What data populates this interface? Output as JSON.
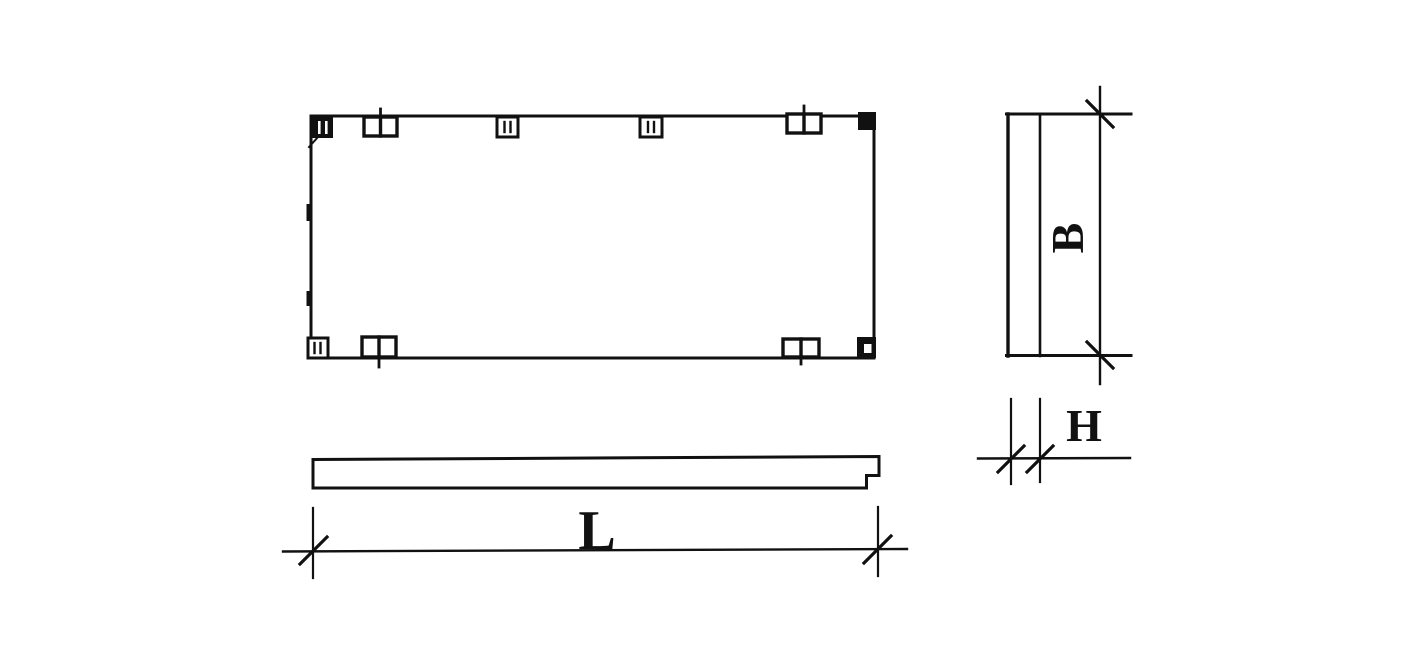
{
  "labels": {
    "length": "L",
    "width": "B",
    "thickness": "H"
  },
  "colors": {
    "ink": "#111111",
    "paper": "#ffffff"
  }
}
